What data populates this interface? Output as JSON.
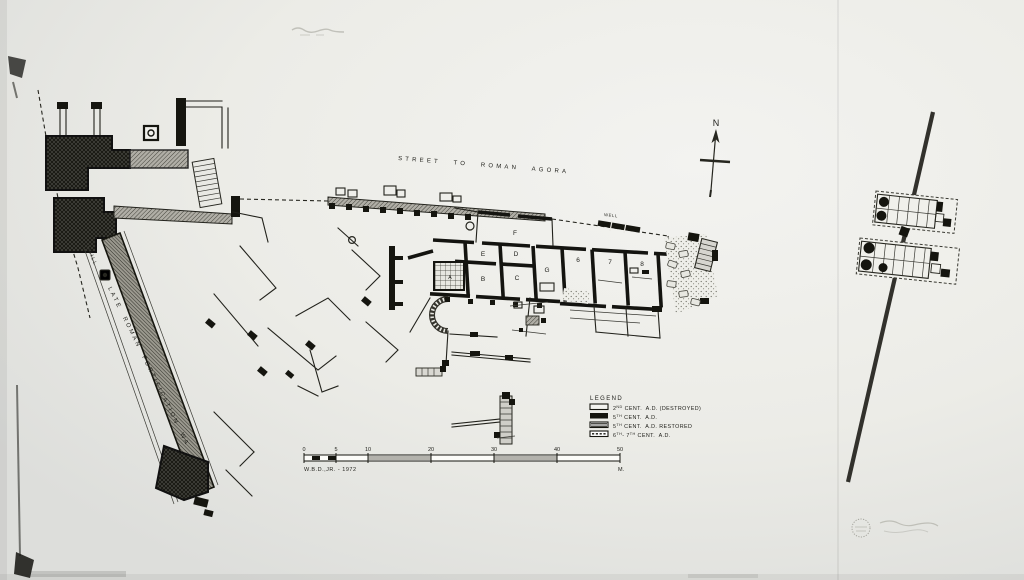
{
  "colors": {
    "ink": "#1c1c16",
    "paper": "#eceded",
    "shade": "#b3b2ac"
  },
  "labels": {
    "street": "STREET TO ROMAN AGORA",
    "fortification_wall": "LATE ROMAN FORTIFICATION WALL",
    "mill": "MILL",
    "well": "WELL",
    "north": "N"
  },
  "rooms": {
    "a": "A",
    "b": "B",
    "c": "C",
    "d": "D",
    "e": "E",
    "f": "F",
    "g": "G",
    "n6": "6",
    "n7": "7",
    "n8": "8"
  },
  "legend": {
    "title": "LEGEND",
    "items": [
      {
        "style": "outline",
        "parts": [
          {
            "t": "2"
          },
          {
            "t": "ND"
          },
          {
            "t": " CENT.  A.D. (DESTROYED)"
          }
        ]
      },
      {
        "style": "solid",
        "parts": [
          {
            "t": "5"
          },
          {
            "t": "TH"
          },
          {
            "t": " CENT.  A.D."
          }
        ]
      },
      {
        "style": "striped",
        "parts": [
          {
            "t": "5"
          },
          {
            "t": "TH"
          },
          {
            "t": " CENT.  A.D. RESTORED"
          }
        ]
      },
      {
        "style": "dashed",
        "parts": [
          {
            "t": "6"
          },
          {
            "t": "TH"
          },
          {
            "t": "- 7"
          },
          {
            "t": "TH"
          },
          {
            "t": " CENT.  A.D."
          }
        ]
      }
    ]
  },
  "scalebar": {
    "ticks": [
      "0",
      "5",
      "10",
      "20",
      "30",
      "40",
      "50"
    ],
    "unit": "M.",
    "signature": "W.B.D.,JR. - 1972"
  }
}
